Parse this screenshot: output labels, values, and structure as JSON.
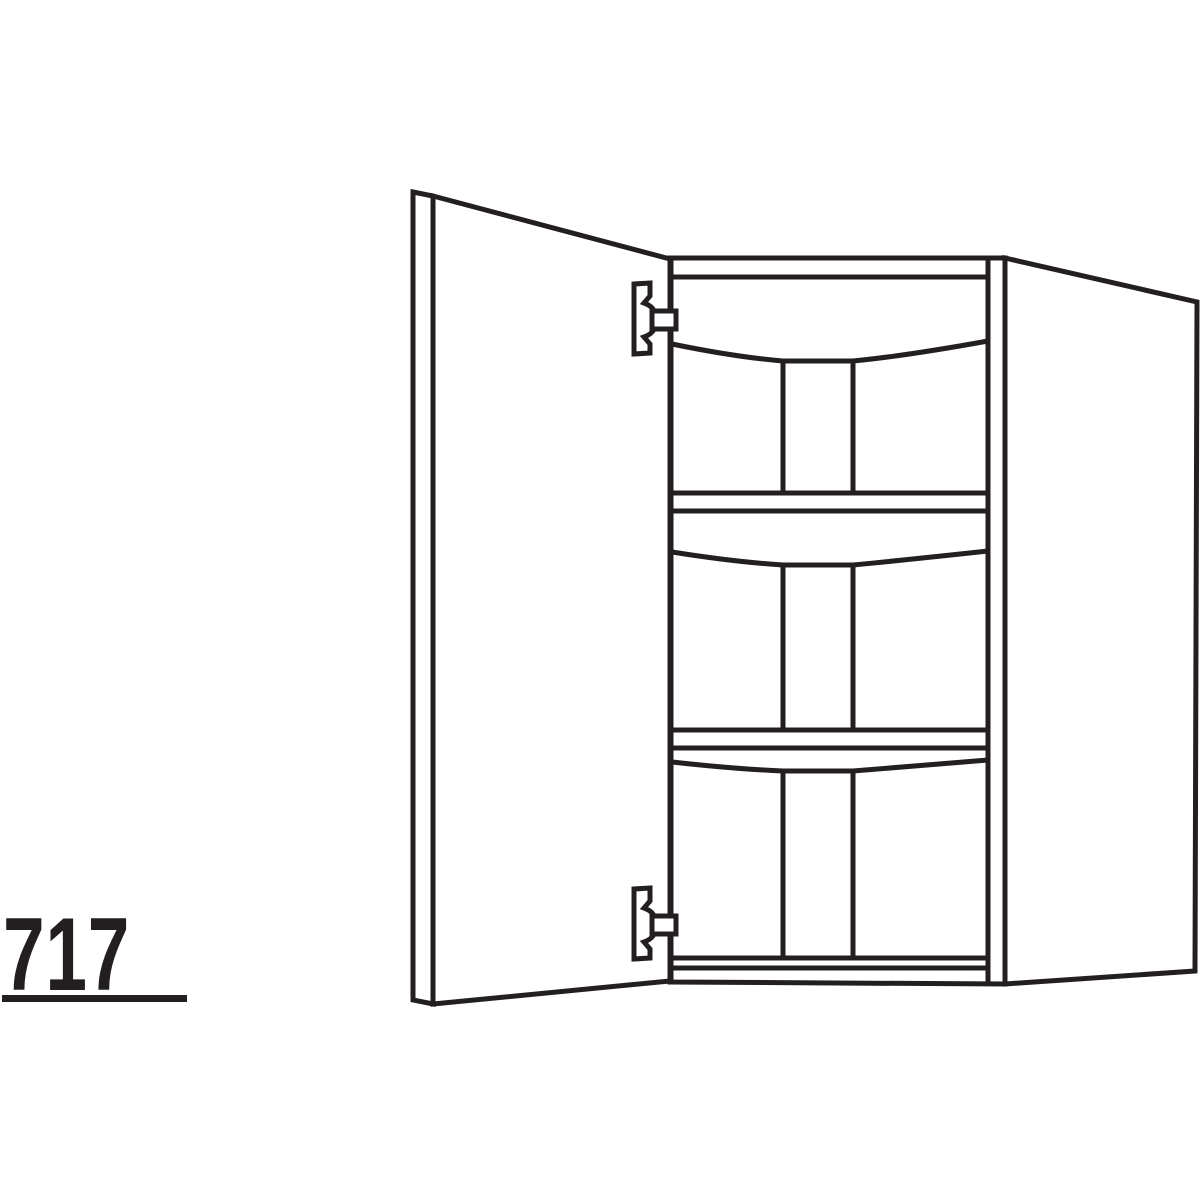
{
  "colors": {
    "line": "#231f20",
    "background": "#ffffff",
    "text": "#231f20"
  },
  "dimension_label": {
    "text": "717",
    "underlined": true
  },
  "drawing": {
    "name": "wall-cabinet-line-drawing",
    "door_state": "open",
    "door_hinge_side": "left",
    "shelf_count": 2,
    "hinge_count": 2
  }
}
